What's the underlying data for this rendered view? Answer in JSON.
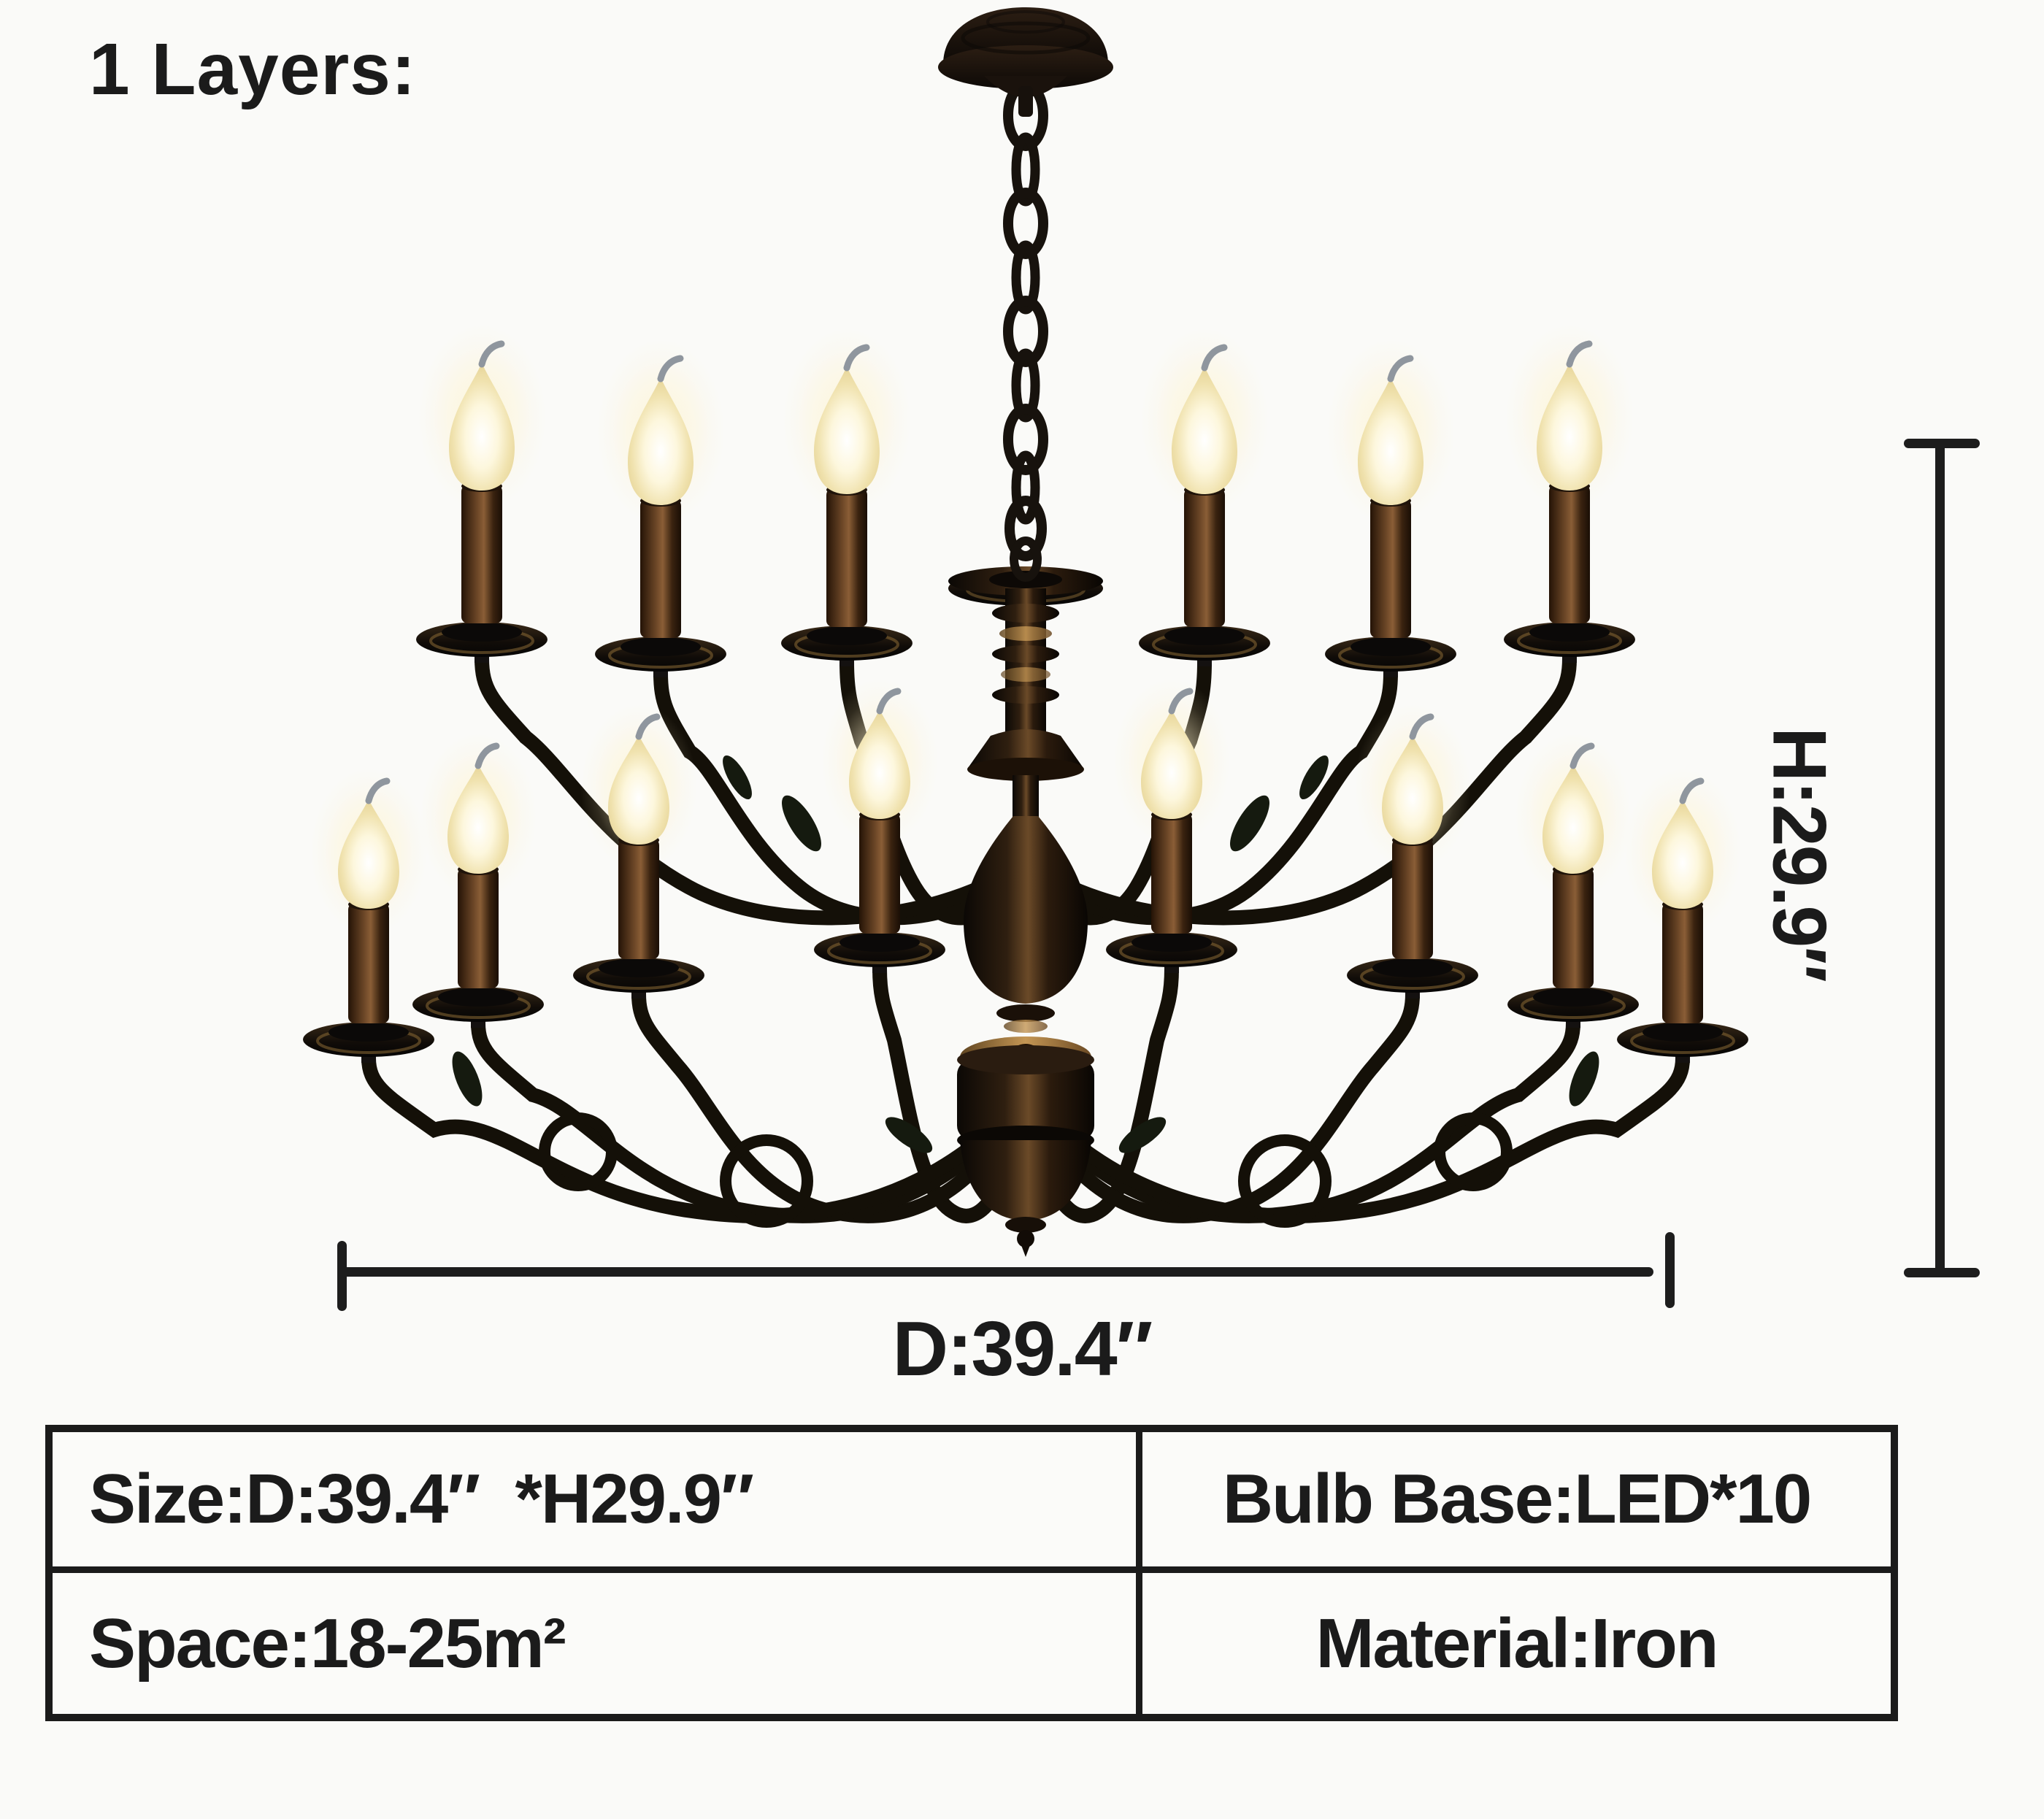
{
  "page": {
    "background": "#fafaf8",
    "ink": "#1b1b1b"
  },
  "annotations": {
    "layers_label": "1 Layers:",
    "height_label": "H:29.9″",
    "diameter_label": "D:39.4″"
  },
  "product_image": {
    "name": "two-tier black iron candle chandelier with flame bulbs",
    "tiers": 1,
    "upper_candles": 6,
    "lower_candles": 8,
    "iron_color": "#141008",
    "bronze_color": "#6b4a28",
    "gold_accent": "#c49654",
    "flame_color": "#f7ecc3"
  },
  "spec_table": {
    "rows": [
      {
        "cells": [
          "Size:D:39.4″  *H29.9″",
          "Bulb Base:LED*10"
        ]
      },
      {
        "cells": [
          "Space:18-25m²",
          "Material:Iron"
        ]
      }
    ]
  }
}
